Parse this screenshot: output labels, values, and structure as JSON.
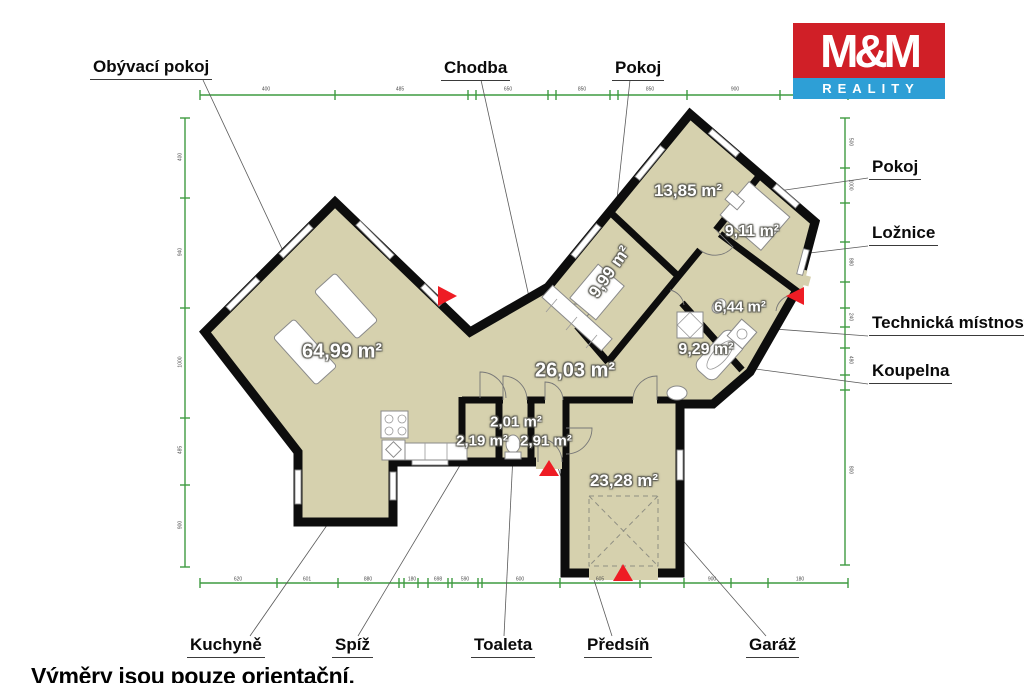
{
  "logo": {
    "name": "M&M",
    "tagline": "REALITY"
  },
  "footnote": "Výměry jsou pouze orientační.",
  "callouts": {
    "obyvaci_pokoj": "Obývací pokoj",
    "chodba": "Chodba",
    "pokoj_top": "Pokoj",
    "pokoj_right": "Pokoj",
    "loznice": "Ložnice",
    "technicka_mistnost": "Technická místnost",
    "koupelna": "Koupelna",
    "kuchyne": "Kuchyně",
    "spiz": "Spíž",
    "toaleta": "Toaleta",
    "predsin": "Předsíň",
    "garaz": "Garáž"
  },
  "areas": {
    "obyvaci_pokoj": "64,99 m²",
    "chodba": "26,03 m²",
    "pokoj_top": "9,99 m²",
    "pokoj_right": "13,85 m²",
    "loznice": "9,11 m²",
    "technicka_mistnost": "6,44 m²",
    "koupelna": "9,29 m²",
    "toaleta": "2,01 m²",
    "spiz": "2,19 m²",
    "predsin": "2,91 m²",
    "garaz": "23,28 m²"
  },
  "colors": {
    "floor": "#d6d1ae",
    "wall": "#0d0d0d",
    "dimension_line": "#3f9b41",
    "entrance_marker": "#ee1c24",
    "logo_red": "#d01f27",
    "logo_blue": "#2e9fd6"
  },
  "dimension_labels": {
    "top": [
      {
        "x": 266,
        "y": 90,
        "t": "400"
      },
      {
        "x": 400,
        "y": 90,
        "t": "485"
      },
      {
        "x": 508,
        "y": 90,
        "t": "650"
      },
      {
        "x": 582,
        "y": 90,
        "t": "850"
      },
      {
        "x": 650,
        "y": 90,
        "t": "850"
      },
      {
        "x": 735,
        "y": 90,
        "t": "900"
      },
      {
        "x": 800,
        "y": 90,
        "t": "893"
      }
    ],
    "bottom": [
      {
        "x": 238,
        "y": 580,
        "t": "620"
      },
      {
        "x": 307,
        "y": 580,
        "t": "601"
      },
      {
        "x": 368,
        "y": 580,
        "t": "880"
      },
      {
        "x": 412,
        "y": 580,
        "t": "180"
      },
      {
        "x": 438,
        "y": 580,
        "t": "698"
      },
      {
        "x": 465,
        "y": 580,
        "t": "590"
      },
      {
        "x": 520,
        "y": 580,
        "t": "600"
      },
      {
        "x": 600,
        "y": 580,
        "t": "605"
      },
      {
        "x": 712,
        "y": 580,
        "t": "900"
      },
      {
        "x": 800,
        "y": 580,
        "t": "180"
      }
    ],
    "left": [
      {
        "x": 181,
        "y": 157,
        "t": "400"
      },
      {
        "x": 181,
        "y": 252,
        "t": "940"
      },
      {
        "x": 181,
        "y": 362,
        "t": "1000"
      },
      {
        "x": 181,
        "y": 450,
        "t": "485"
      },
      {
        "x": 181,
        "y": 525,
        "t": "900"
      }
    ],
    "right": [
      {
        "x": 850,
        "y": 142,
        "t": "500"
      },
      {
        "x": 850,
        "y": 185,
        "t": "1000"
      },
      {
        "x": 850,
        "y": 262,
        "t": "880"
      },
      {
        "x": 850,
        "y": 317,
        "t": "240"
      },
      {
        "x": 850,
        "y": 360,
        "t": "480"
      },
      {
        "x": 850,
        "y": 470,
        "t": "800"
      }
    ]
  },
  "dimension_ticks": {
    "top": [
      200,
      335,
      468,
      476,
      548,
      556,
      610,
      618,
      687,
      780,
      848
    ],
    "bottom": [
      200,
      277,
      338,
      399,
      404,
      418,
      428,
      448,
      452,
      478,
      482,
      560,
      640,
      684,
      731,
      768,
      848
    ],
    "left": [
      118,
      198,
      308,
      418,
      485,
      567
    ],
    "right": [
      118,
      168,
      203,
      242,
      282,
      308,
      327,
      348,
      375,
      390,
      565
    ]
  }
}
